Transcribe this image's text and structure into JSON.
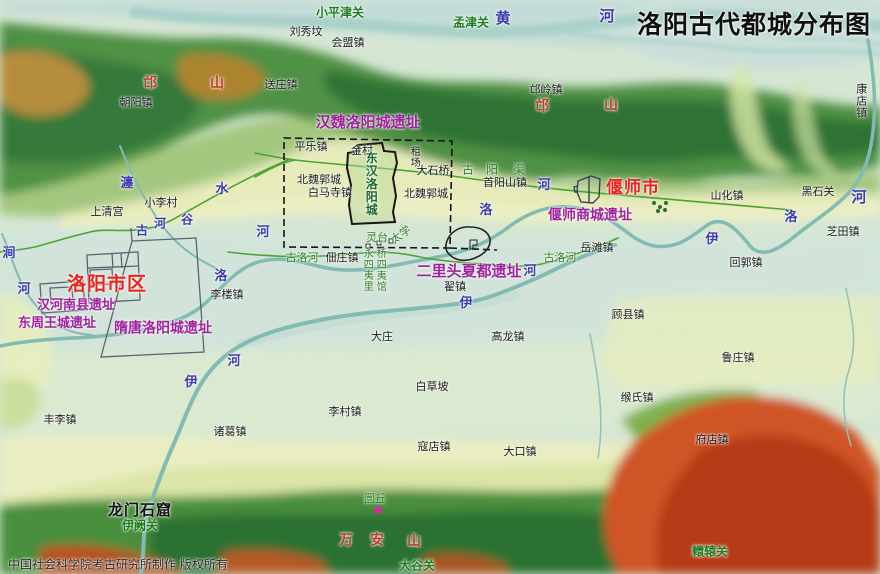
{
  "title": {
    "text": "洛阳古代都城分布图"
  },
  "credit": {
    "text": "中国社会科学院考古研究所制作  版权所有"
  },
  "colors": {
    "city_red": "#e8251f",
    "site_magenta": "#a0239e",
    "mountain_red": "#c43d27",
    "river_blue": "#3c3cae",
    "pass_green": "#1e7d22",
    "ancient_green": "#2e7d27",
    "water_teal": "#85bdb4",
    "road_green": "#4aa332",
    "marker_magenta": "#cc3399",
    "terrain_valley": "#d5e6d3",
    "terrain_hill": "#4f9145",
    "terrain_red": "#c8431f"
  },
  "labels": [
    {
      "t": "刘秀坟",
      "x": 306,
      "y": 32,
      "k": "town"
    },
    {
      "t": "会盟镇",
      "x": 348,
      "y": 43,
      "k": "town"
    },
    {
      "t": "送庄镇",
      "x": 281,
      "y": 85,
      "k": "town"
    },
    {
      "t": "朝阳镇",
      "x": 136,
      "y": 103,
      "k": "town"
    },
    {
      "t": "邙岭镇",
      "x": 546,
      "y": 90,
      "k": "town"
    },
    {
      "t": "康店镇",
      "x": 861,
      "y": 101,
      "k": "town",
      "v": 1
    },
    {
      "t": "上清宫",
      "x": 107,
      "y": 212,
      "k": "town"
    },
    {
      "t": "小李村",
      "x": 161,
      "y": 203,
      "k": "town"
    },
    {
      "t": "平乐镇",
      "x": 311,
      "y": 147,
      "k": "town"
    },
    {
      "t": "金村",
      "x": 362,
      "y": 151,
      "k": "town"
    },
    {
      "t": "租场",
      "x": 413,
      "y": 157,
      "k": "town",
      "v": 1,
      "s": 10
    },
    {
      "t": "大石桥",
      "x": 433,
      "y": 171,
      "k": "town"
    },
    {
      "t": "北魏郭城",
      "x": 319,
      "y": 180,
      "k": "town"
    },
    {
      "t": "白马寺镇",
      "x": 330,
      "y": 193,
      "k": "town"
    },
    {
      "t": "北魏郭城",
      "x": 426,
      "y": 194,
      "k": "town"
    },
    {
      "t": "首阳山镇",
      "x": 505,
      "y": 183,
      "k": "town"
    },
    {
      "t": "山化镇",
      "x": 727,
      "y": 196,
      "k": "town"
    },
    {
      "t": "黑石关",
      "x": 818,
      "y": 192,
      "k": "town"
    },
    {
      "t": "芝田镇",
      "x": 843,
      "y": 232,
      "k": "town"
    },
    {
      "t": "李楼镇",
      "x": 227,
      "y": 295,
      "k": "town"
    },
    {
      "t": "佃庄镇",
      "x": 342,
      "y": 258,
      "k": "town"
    },
    {
      "t": "翟镇",
      "x": 455,
      "y": 287,
      "k": "town"
    },
    {
      "t": "岳滩镇",
      "x": 597,
      "y": 248,
      "k": "town"
    },
    {
      "t": "回郭镇",
      "x": 746,
      "y": 263,
      "k": "town"
    },
    {
      "t": "顾县镇",
      "x": 628,
      "y": 315,
      "k": "town"
    },
    {
      "t": "鲁庄镇",
      "x": 738,
      "y": 358,
      "k": "town"
    },
    {
      "t": "缑氏镇",
      "x": 637,
      "y": 398,
      "k": "town"
    },
    {
      "t": "府店镇",
      "x": 712,
      "y": 440,
      "k": "town"
    },
    {
      "t": "大庄",
      "x": 382,
      "y": 337,
      "k": "town"
    },
    {
      "t": "高龙镇",
      "x": 508,
      "y": 337,
      "k": "town"
    },
    {
      "t": "白草坡",
      "x": 432,
      "y": 387,
      "k": "town"
    },
    {
      "t": "李村镇",
      "x": 345,
      "y": 412,
      "k": "town"
    },
    {
      "t": "寇店镇",
      "x": 434,
      "y": 447,
      "k": "town"
    },
    {
      "t": "大口镇",
      "x": 520,
      "y": 452,
      "k": "town"
    },
    {
      "t": "丰李镇",
      "x": 60,
      "y": 420,
      "k": "town"
    },
    {
      "t": "诸葛镇",
      "x": 230,
      "y": 432,
      "k": "town"
    },
    {
      "t": "龙门石窟",
      "x": 140,
      "y": 511,
      "k": "town-lg"
    },
    {
      "t": "洛阳市区",
      "x": 107,
      "y": 285,
      "k": "city"
    },
    {
      "t": "偃师市",
      "x": 633,
      "y": 189,
      "k": "city",
      "s": 17
    },
    {
      "t": "汉魏洛阳城遗址",
      "x": 368,
      "y": 123,
      "k": "site",
      "s": 15
    },
    {
      "t": "汉河南县遗址",
      "x": 76,
      "y": 306,
      "k": "site",
      "s": 13
    },
    {
      "t": "东周王城遗址",
      "x": 57,
      "y": 324,
      "k": "site",
      "s": 13
    },
    {
      "t": "隋唐洛阳城遗址",
      "x": 163,
      "y": 329,
      "k": "site"
    },
    {
      "t": "二里头夏都遗址",
      "x": 469,
      "y": 272,
      "k": "site",
      "s": 15
    },
    {
      "t": "偃师商城遗址",
      "x": 590,
      "y": 216,
      "k": "site"
    },
    {
      "t": "邙",
      "x": 150,
      "y": 84,
      "k": "mtn"
    },
    {
      "t": "山",
      "x": 217,
      "y": 84,
      "k": "mtn"
    },
    {
      "t": "邙",
      "x": 542,
      "y": 107,
      "k": "mtn"
    },
    {
      "t": "山",
      "x": 611,
      "y": 106,
      "k": "mtn"
    },
    {
      "t": "万",
      "x": 346,
      "y": 541,
      "k": "mtn"
    },
    {
      "t": "安",
      "x": 377,
      "y": 541,
      "k": "mtn"
    },
    {
      "t": "山",
      "x": 414,
      "y": 542,
      "k": "mtn"
    },
    {
      "t": "黄",
      "x": 503,
      "y": 19,
      "k": "river",
      "s": 15
    },
    {
      "t": "河",
      "x": 607,
      "y": 17,
      "k": "river",
      "s": 15
    },
    {
      "t": "瀍",
      "x": 127,
      "y": 184,
      "k": "river"
    },
    {
      "t": "水",
      "x": 222,
      "y": 190,
      "k": "river"
    },
    {
      "t": "古",
      "x": 142,
      "y": 231,
      "k": "river",
      "s": 12
    },
    {
      "t": "河",
      "x": 160,
      "y": 224,
      "k": "river",
      "s": 12
    },
    {
      "t": "谷",
      "x": 187,
      "y": 220,
      "k": "river",
      "s": 12
    },
    {
      "t": "河",
      "x": 263,
      "y": 233,
      "k": "river"
    },
    {
      "t": "涧",
      "x": 9,
      "y": 254,
      "k": "river"
    },
    {
      "t": "河",
      "x": 24,
      "y": 290,
      "k": "river"
    },
    {
      "t": "洛",
      "x": 221,
      "y": 277,
      "k": "river"
    },
    {
      "t": "洛",
      "x": 486,
      "y": 211,
      "k": "river"
    },
    {
      "t": "河",
      "x": 544,
      "y": 186,
      "k": "river"
    },
    {
      "t": "伊",
      "x": 466,
      "y": 304,
      "k": "river"
    },
    {
      "t": "河",
      "x": 530,
      "y": 272,
      "k": "river"
    },
    {
      "t": "伊",
      "x": 712,
      "y": 240,
      "k": "river"
    },
    {
      "t": "洛",
      "x": 791,
      "y": 218,
      "k": "river"
    },
    {
      "t": "河",
      "x": 859,
      "y": 198,
      "k": "river",
      "s": 15
    },
    {
      "t": "河",
      "x": 234,
      "y": 362,
      "k": "river"
    },
    {
      "t": "伊",
      "x": 191,
      "y": 383,
      "k": "river"
    },
    {
      "t": "小平津关",
      "x": 340,
      "y": 13,
      "k": "pass"
    },
    {
      "t": "孟津关",
      "x": 471,
      "y": 23,
      "k": "pass"
    },
    {
      "t": "伊阙关",
      "x": 140,
      "y": 526,
      "k": "pass"
    },
    {
      "t": "大谷关",
      "x": 417,
      "y": 566,
      "k": "pass"
    },
    {
      "t": "轘辕关",
      "x": 710,
      "y": 552,
      "k": "pass"
    },
    {
      "t": "古",
      "x": 468,
      "y": 170,
      "k": "anc",
      "s": 12
    },
    {
      "t": "阳",
      "x": 492,
      "y": 170,
      "k": "anc",
      "s": 12
    },
    {
      "t": "渠",
      "x": 519,
      "y": 170,
      "k": "anc",
      "s": 12
    },
    {
      "t": "古洛河",
      "x": 302,
      "y": 258,
      "k": "anc"
    },
    {
      "t": "古洛河",
      "x": 560,
      "y": 258,
      "k": "anc"
    },
    {
      "t": "灵台",
      "x": 377,
      "y": 238,
      "k": "anc"
    },
    {
      "t": "太学",
      "x": 401,
      "y": 235,
      "k": "anc",
      "r": -35
    },
    {
      "t": "永四夷里",
      "x": 366,
      "y": 270,
      "k": "anc",
      "v": 1,
      "s": 10
    },
    {
      "t": "桥四夷馆",
      "x": 379,
      "y": 270,
      "k": "anc",
      "v": 1,
      "s": 10
    },
    {
      "t": "圜丘",
      "x": 375,
      "y": 499,
      "k": "anc"
    },
    {
      "t": "东汉洛阳城",
      "x": 371,
      "y": 184,
      "k": "anc-city",
      "v": 1
    }
  ]
}
